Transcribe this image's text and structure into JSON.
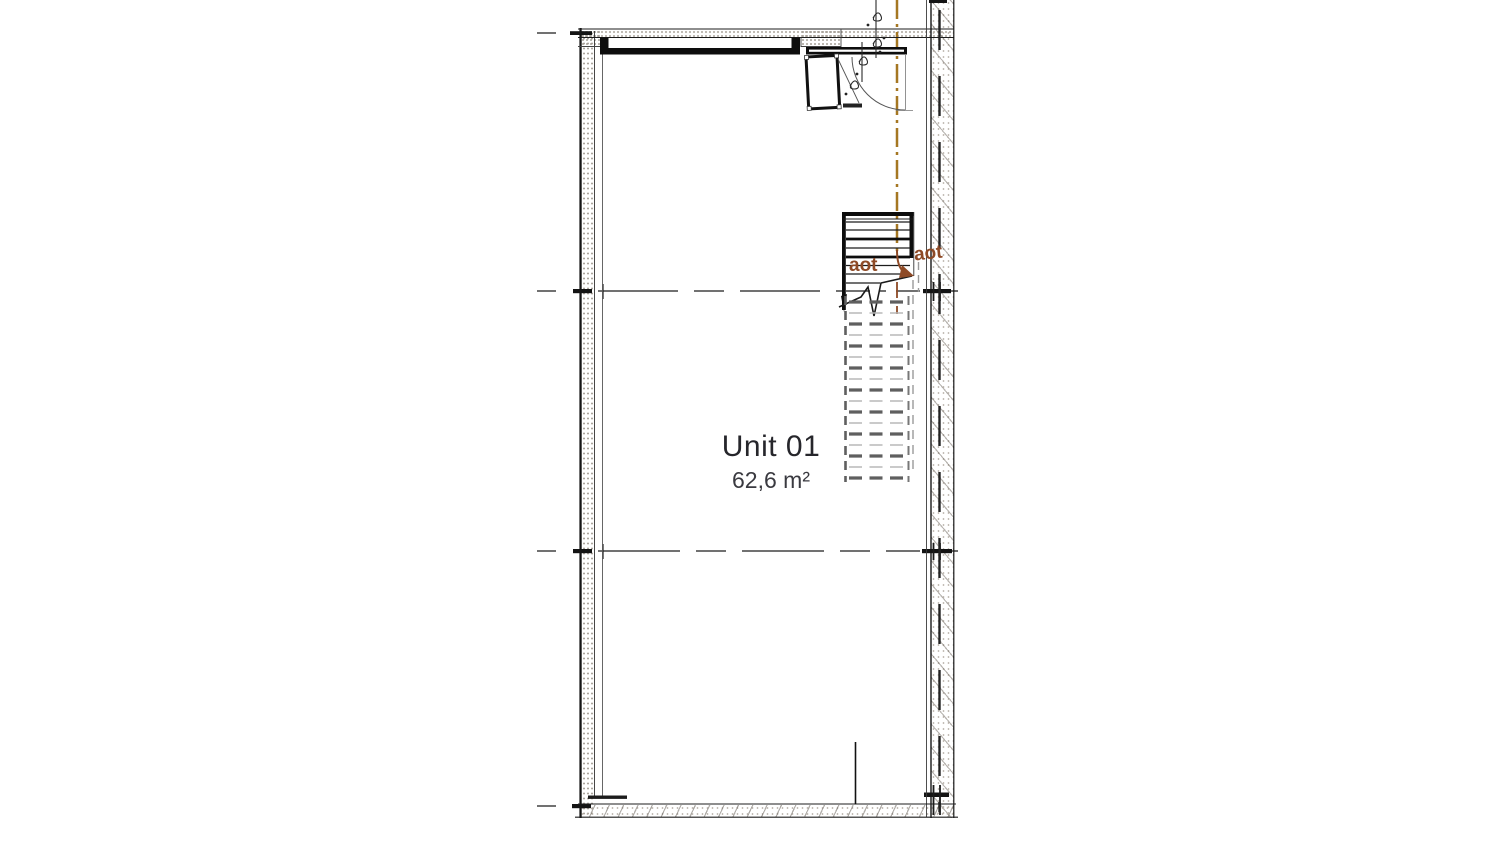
{
  "plan": {
    "unit": {
      "name": "Unit 01",
      "area": "62,6 m²"
    },
    "annotations": {
      "stair_note_left": "aot",
      "stair_note_right": "aot"
    },
    "colors": {
      "ink": "#1c1c1c",
      "centerline_orange": "#a57722",
      "annotation_brown": "#8e4a26",
      "hatch_gray": "#aaa39a",
      "stair_dash_dark": "#5f5f5f",
      "stair_dash_light": "#b8b8b8"
    }
  }
}
